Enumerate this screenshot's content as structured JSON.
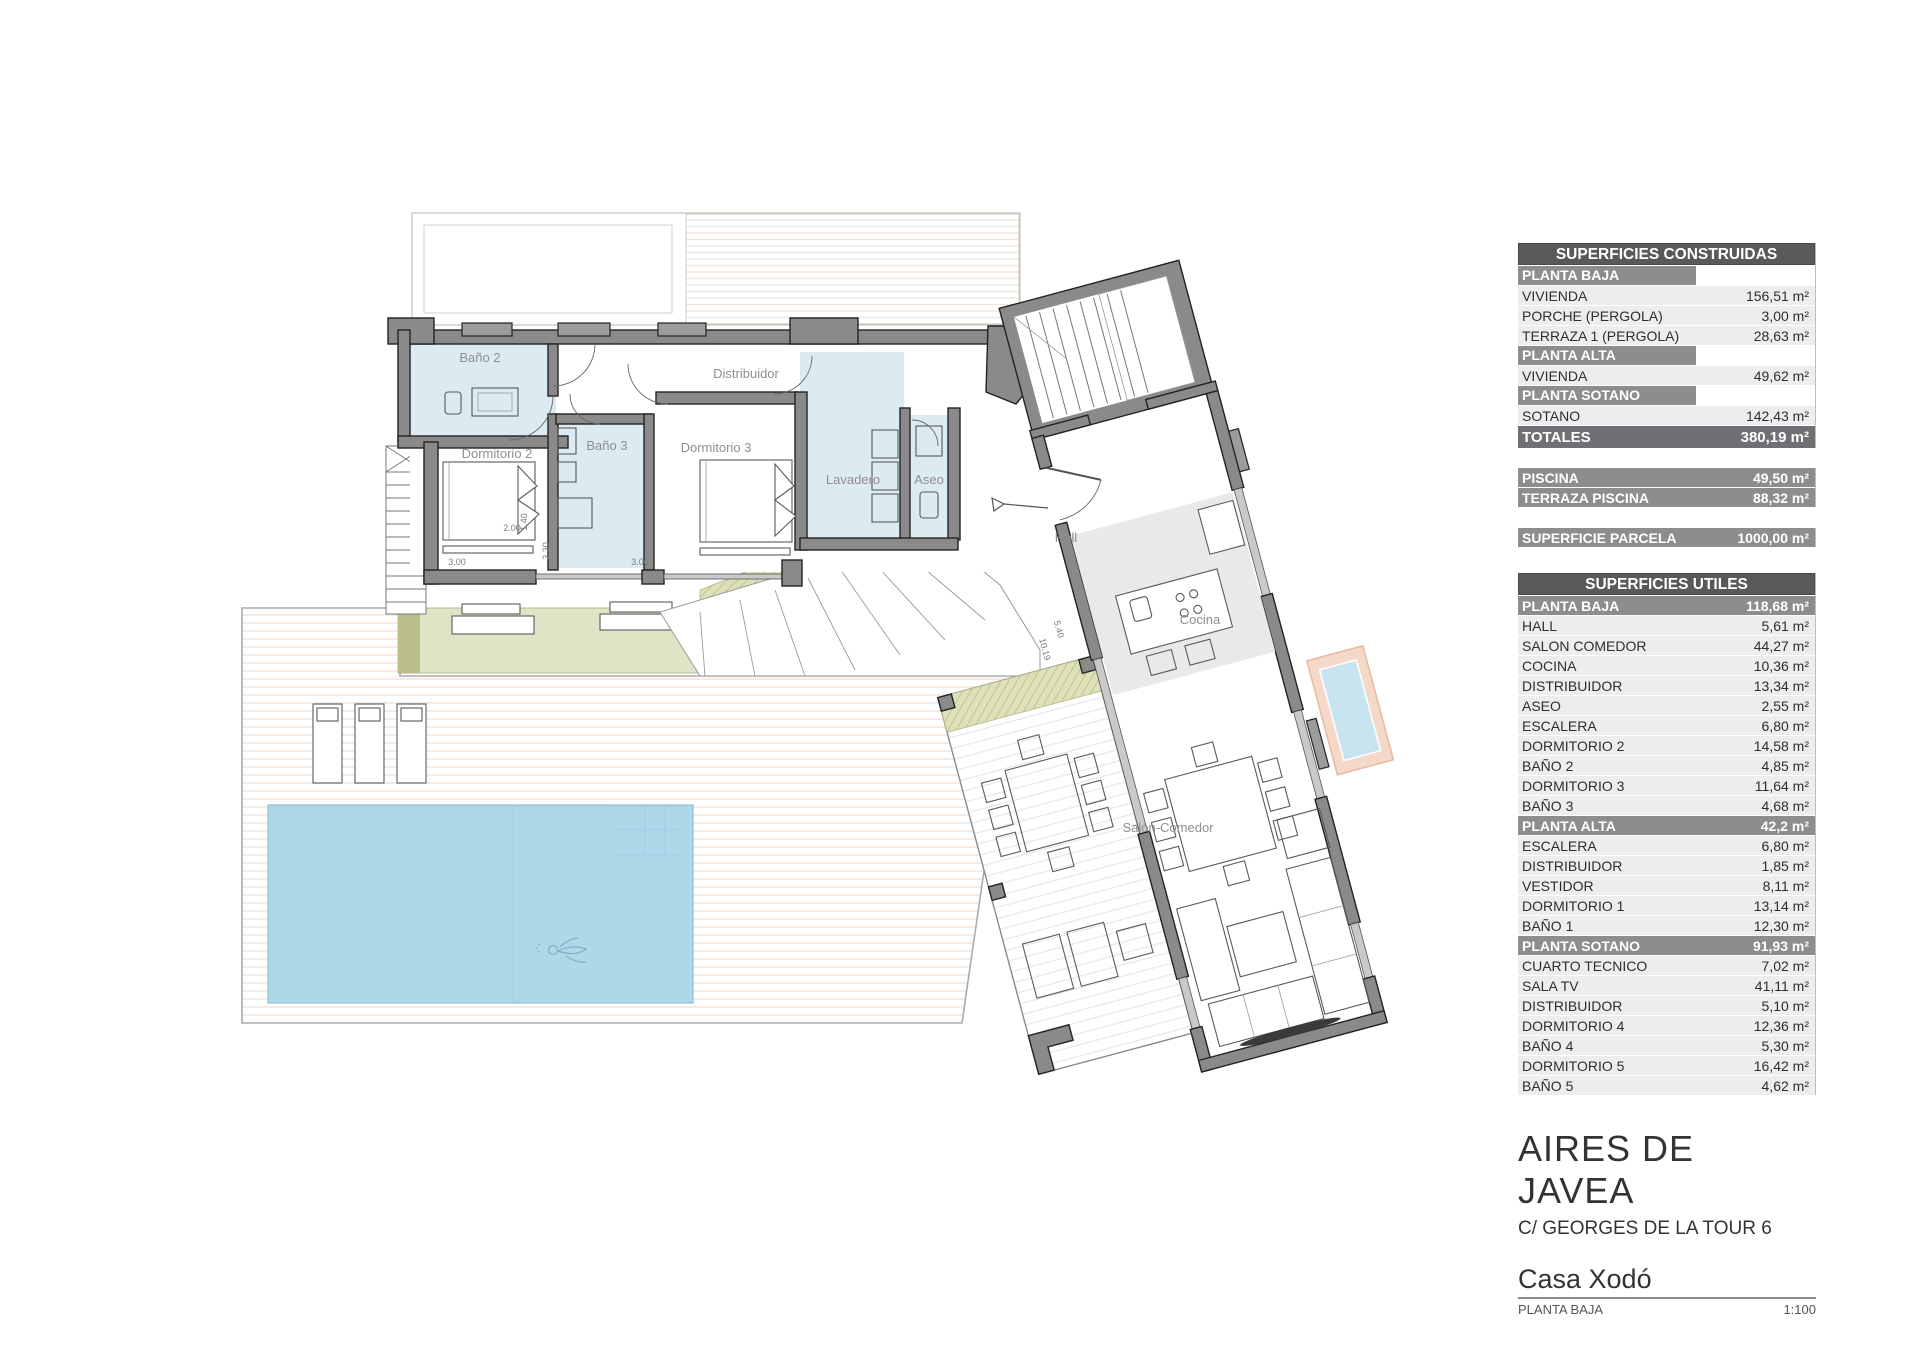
{
  "plan": {
    "rooms": {
      "bano2": "Baño 2",
      "dormitorio2": "Dormitorio 2",
      "bano3": "Baño 3",
      "dormitorio3": "Dormitorio 3",
      "lavadero": "Lavadero",
      "aseo": "Aseo",
      "distribuidor": "Distribuidor",
      "hall": "Hall",
      "cocina": "Cocina",
      "salon": "Salón-Comedor"
    },
    "dimensions": {
      "bed_width": "2.00",
      "bed_length": "1.40",
      "dorm2_width": "3.00",
      "dorm2_depth": "3.30",
      "dorm3_width": "3.00",
      "wing_a": "5.40",
      "wing_b": "10.19"
    },
    "colors": {
      "wall": "#8A8A8A",
      "bathroom_floor": "#DCEAF2",
      "pool": "#ACD8EA",
      "terrace_green": "#E0E4C6",
      "planter_accent": "#EFC3A8"
    }
  },
  "sidebar": {
    "construidas": {
      "title": "SUPERFICIES CONSTRUIDAS",
      "sections": [
        {
          "header": "PLANTA BAJA",
          "rows": [
            {
              "label": "VIVIENDA",
              "value": "156,51 m²"
            },
            {
              "label": "PORCHE (PERGOLA)",
              "value": "3,00 m²"
            },
            {
              "label": "TERRAZA 1 (PERGOLA)",
              "value": "28,63 m²"
            }
          ]
        },
        {
          "header": "PLANTA ALTA",
          "rows": [
            {
              "label": "VIVIENDA",
              "value": "49,62 m²"
            }
          ]
        },
        {
          "header": "PLANTA SOTANO",
          "rows": [
            {
              "label": "SOTANO",
              "value": "142,43 m²"
            }
          ]
        }
      ],
      "total": {
        "label": "TOTALES",
        "value": "380,19 m²"
      }
    },
    "piscina": {
      "rows": [
        {
          "label": "PISCINA",
          "value": "49,50 m²"
        },
        {
          "label": "TERRAZA PISCINA",
          "value": "88,32 m²"
        }
      ]
    },
    "parcela": {
      "label": "SUPERFICIE PARCELA",
      "value": "1000,00 m²"
    },
    "utiles": {
      "title": "SUPERFICIES UTILES",
      "groups": [
        {
          "header": "PLANTA BAJA",
          "value": "118,68 m²",
          "rows": [
            {
              "label": "HALL",
              "value": "5,61 m²"
            },
            {
              "label": "SALON COMEDOR",
              "value": "44,27 m²"
            },
            {
              "label": "COCINA",
              "value": "10,36 m²"
            },
            {
              "label": "DISTRIBUIDOR",
              "value": "13,34 m²"
            },
            {
              "label": "ASEO",
              "value": "2,55 m²"
            },
            {
              "label": "ESCALERA",
              "value": "6,80 m²"
            },
            {
              "label": "DORMITORIO 2",
              "value": "14,58 m²"
            },
            {
              "label": "BAÑO 2",
              "value": "4,85 m²"
            },
            {
              "label": "DORMITORIO 3",
              "value": "11,64 m²"
            },
            {
              "label": "BAÑO 3",
              "value": "4,68 m²"
            }
          ]
        },
        {
          "header": "PLANTA ALTA",
          "value": "42,2 m²",
          "rows": [
            {
              "label": "ESCALERA",
              "value": "6,80 m²"
            },
            {
              "label": "DISTRIBUIDOR",
              "value": "1,85 m²"
            },
            {
              "label": "VESTIDOR",
              "value": "8,11 m²"
            },
            {
              "label": "DORMITORIO 1",
              "value": "13,14 m²"
            },
            {
              "label": "BAÑO 1",
              "value": "12,30 m²"
            }
          ]
        },
        {
          "header": "PLANTA SOTANO",
          "value": "91,93 m²",
          "rows": [
            {
              "label": "CUARTO TECNICO",
              "value": "7,02 m²"
            },
            {
              "label": "SALA TV",
              "value": "41,11 m²"
            },
            {
              "label": "DISTRIBUIDOR",
              "value": "5,10 m²"
            },
            {
              "label": "DORMITORIO 4",
              "value": "12,36 m²"
            },
            {
              "label": "BAÑO 4",
              "value": "5,30 m²"
            },
            {
              "label": "DORMITORIO 5",
              "value": "16,42 m²"
            },
            {
              "label": "BAÑO 5",
              "value": "4,62 m²"
            }
          ]
        }
      ]
    }
  },
  "title_block": {
    "project": "AIRES DE JAVEA",
    "address": "C/ GEORGES DE LA TOUR 6",
    "house_name": "Casa Xodó",
    "sheet_name": "PLANTA BAJA",
    "scale": "1:100"
  }
}
